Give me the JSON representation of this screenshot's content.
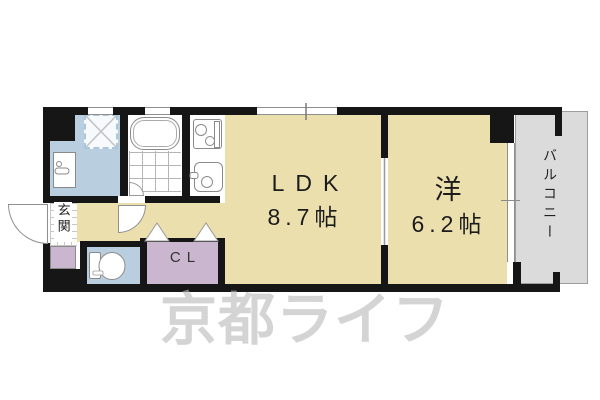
{
  "watermark": {
    "text": "京都ライフ"
  },
  "rooms": {
    "ldk": {
      "label": "LDK",
      "size": "8.7帖"
    },
    "western": {
      "label": "洋",
      "size": "6.2帖"
    },
    "balcony": {
      "label": "バルコニー"
    },
    "entrance": {
      "label": "玄関"
    },
    "closet": {
      "label": "CL"
    }
  },
  "icons": {
    "bathtub": "bathtub-icon",
    "stove": "stove-icon",
    "sink": "sink-icon",
    "vanity": "vanity-icon",
    "toilet": "toilet-icon",
    "washer_pan": "washing-machine-pan-icon",
    "folding_door": "folding-door-icon",
    "swing_door": "swing-door-icon",
    "window": "window-icon"
  },
  "colors": {
    "room_tan": "#ecdfae",
    "wet_area_blue": "#b9cede",
    "closet_purple": "#cab6ce",
    "balcony_gray": "#dbdbdb",
    "wall_black": "#161616",
    "watermark_gray": "#bababa"
  }
}
